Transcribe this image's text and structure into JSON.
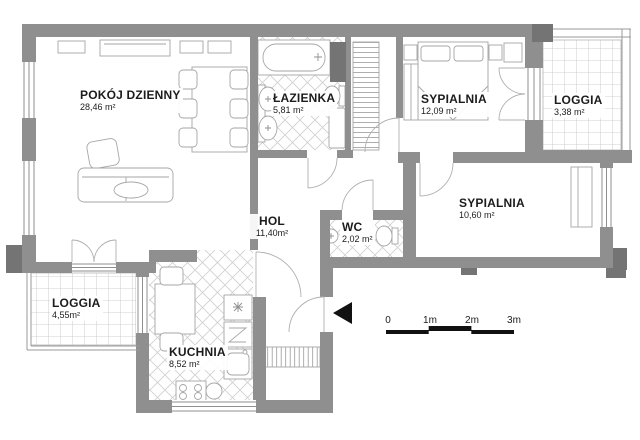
{
  "plan": {
    "rooms": [
      {
        "id": "pokoj-dzienny",
        "name": "POKÓJ DZIENNY",
        "area": "28,46 m²"
      },
      {
        "id": "lazienka",
        "name": "ŁAZIENKA",
        "area": "5,81 m²"
      },
      {
        "id": "sypialnia-gorna",
        "name": "SYPIALNIA",
        "area": "12,09 m²"
      },
      {
        "id": "loggia-prawa",
        "name": "LOGGIA",
        "area": "3,38 m²"
      },
      {
        "id": "sypialnia-prawa",
        "name": "SYPIALNIA",
        "area": "10,60 m²"
      },
      {
        "id": "hol",
        "name": "HOL",
        "area": "11,40m²"
      },
      {
        "id": "wc",
        "name": "WC",
        "area": "2,02 m²"
      },
      {
        "id": "loggia-lewa",
        "name": "LOGGIA",
        "area": "4,55m²"
      },
      {
        "id": "kuchnia",
        "name": "KUCHNIA",
        "area": "8,52 m²"
      }
    ],
    "scale_bar": {
      "labels": [
        "0",
        "1m",
        "2m",
        "3m"
      ]
    },
    "colors": {
      "wall": "#8f8f8f",
      "wall_dark": "#747474",
      "marker": "#111111"
    }
  }
}
